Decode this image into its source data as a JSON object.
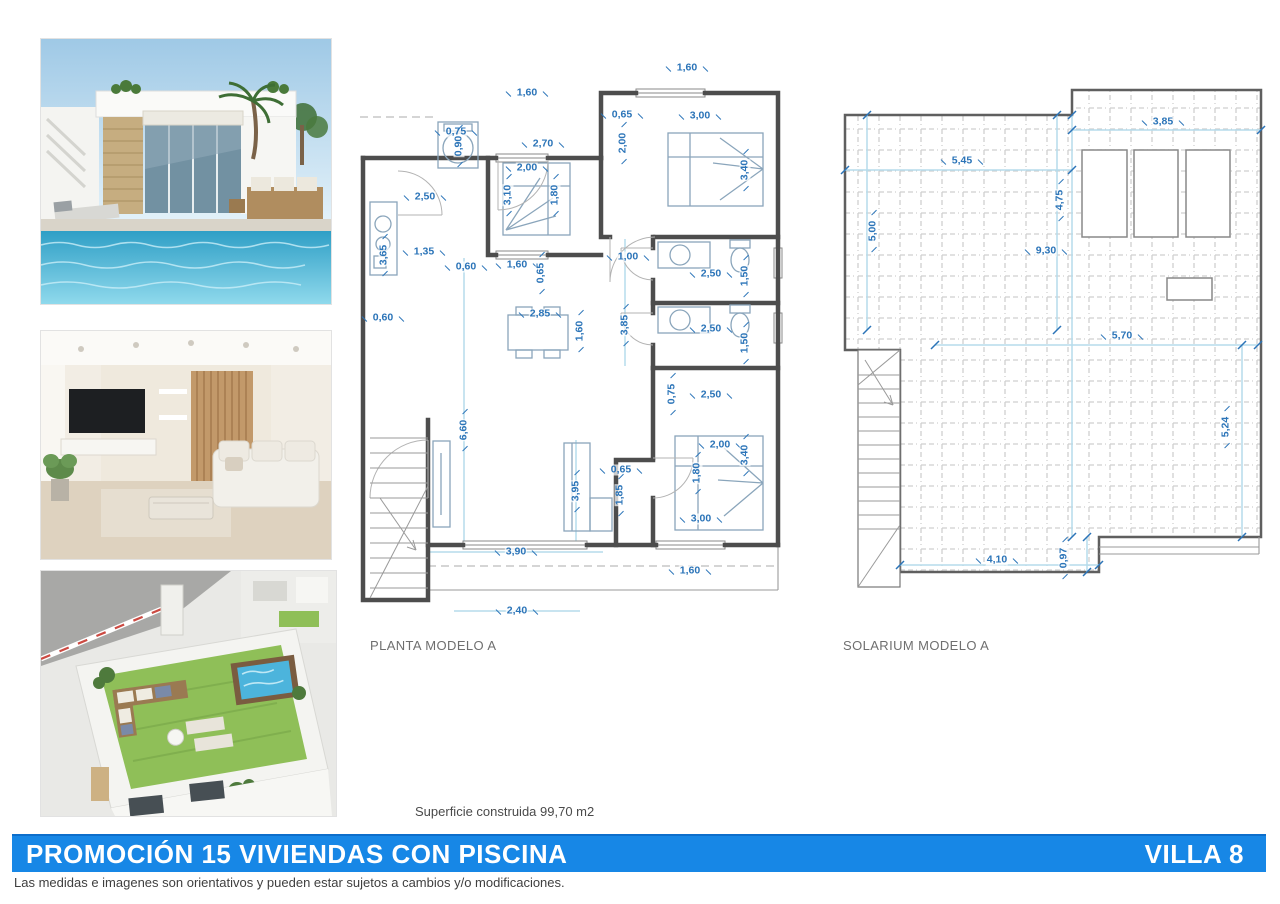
{
  "page": {
    "surface_note": "Superficie construida 99,70 m2",
    "banner": {
      "title": "PROMOCIÓN 15 VIVIENDAS CON PISCINA",
      "villa_label": "VILLA 8",
      "color": "#1787e6"
    },
    "disclaimer": "Las medidas e imagenes son orientativos y pueden estar sujetos a cambios y/o modificaciones."
  },
  "photos": [
    {
      "name": "villa-exterior-pool",
      "description": "Render of a white modern villa with stone pillar, covered terrace, rattan sofas, palm trees and private pool"
    },
    {
      "name": "living-room-interior",
      "description": "Render of a living room with TV wall, wood slat panel, white sofa and coffee table"
    },
    {
      "name": "rooftop-solarium-aerial",
      "description": "Aerial render of the rooftop solarium with artificial grass, lounge furniture and jacuzzi"
    }
  ],
  "colors": {
    "dimension_text": "#2b74b8",
    "walls": "#4d4d4d",
    "banner_blue": "#1787e6"
  },
  "plans": {
    "planta": {
      "label": "PLANTA MODELO A",
      "dimensions": [
        {
          "t": "1,60",
          "x": 169,
          "y": 35
        },
        {
          "t": "1,60",
          "x": 329,
          "y": 10
        },
        {
          "t": "0,75",
          "x": 98,
          "y": 74
        },
        {
          "t": "0,90",
          "x": 101,
          "y": 88,
          "r": true
        },
        {
          "t": "2,70",
          "x": 185,
          "y": 86
        },
        {
          "t": "2,00",
          "x": 169,
          "y": 110
        },
        {
          "t": "3,10",
          "x": 150,
          "y": 137,
          "r": true
        },
        {
          "t": "1,80",
          "x": 197,
          "y": 137,
          "r": true
        },
        {
          "t": "3,40",
          "x": 387,
          "y": 112,
          "r": true
        },
        {
          "t": "0,65",
          "x": 264,
          "y": 57
        },
        {
          "t": "3,00",
          "x": 342,
          "y": 58
        },
        {
          "t": "2,00",
          "x": 265,
          "y": 85,
          "r": true
        },
        {
          "t": "2,50",
          "x": 67,
          "y": 139
        },
        {
          "t": "1,35",
          "x": 66,
          "y": 194
        },
        {
          "t": "3,65",
          "x": 26,
          "y": 197,
          "r": true
        },
        {
          "t": "0,60",
          "x": 108,
          "y": 209
        },
        {
          "t": "1,60",
          "x": 159,
          "y": 207
        },
        {
          "t": "0,65",
          "x": 183,
          "y": 215,
          "r": true
        },
        {
          "t": "0,60",
          "x": 25,
          "y": 260
        },
        {
          "t": "1,00",
          "x": 270,
          "y": 199
        },
        {
          "t": "2,50",
          "x": 353,
          "y": 216
        },
        {
          "t": "1,50",
          "x": 387,
          "y": 218,
          "r": true
        },
        {
          "t": "2,85",
          "x": 182,
          "y": 256
        },
        {
          "t": "1,60",
          "x": 222,
          "y": 273,
          "r": true
        },
        {
          "t": "3,85",
          "x": 267,
          "y": 267,
          "r": true
        },
        {
          "t": "2,50",
          "x": 353,
          "y": 271
        },
        {
          "t": "1,50",
          "x": 387,
          "y": 285,
          "r": true
        },
        {
          "t": "0,75",
          "x": 314,
          "y": 336,
          "r": true
        },
        {
          "t": "2,50",
          "x": 353,
          "y": 337
        },
        {
          "t": "6,60",
          "x": 106,
          "y": 372,
          "r": true
        },
        {
          "t": "2,00",
          "x": 362,
          "y": 387
        },
        {
          "t": "1,80",
          "x": 339,
          "y": 415,
          "r": true
        },
        {
          "t": "3,40",
          "x": 387,
          "y": 397,
          "r": true
        },
        {
          "t": "0,65",
          "x": 263,
          "y": 412
        },
        {
          "t": "1,85",
          "x": 262,
          "y": 437,
          "r": true
        },
        {
          "t": "3,95",
          "x": 218,
          "y": 433,
          "r": true
        },
        {
          "t": "3,00",
          "x": 343,
          "y": 461
        },
        {
          "t": "3,90",
          "x": 158,
          "y": 494
        },
        {
          "t": "1,60",
          "x": 332,
          "y": 513
        },
        {
          "t": "2,40",
          "x": 159,
          "y": 553
        }
      ]
    },
    "solarium": {
      "label": "SOLARIUM MODELO A",
      "dimensions": [
        {
          "t": "3,85",
          "x": 328,
          "y": 37
        },
        {
          "t": "5,45",
          "x": 127,
          "y": 76
        },
        {
          "t": "5,00",
          "x": 38,
          "y": 146,
          "r": true
        },
        {
          "t": "4,75",
          "x": 225,
          "y": 115,
          "r": true
        },
        {
          "t": "9,30",
          "x": 211,
          "y": 166
        },
        {
          "t": "5,70",
          "x": 287,
          "y": 251
        },
        {
          "t": "5,24",
          "x": 391,
          "y": 342,
          "r": true
        },
        {
          "t": "4,10",
          "x": 162,
          "y": 475
        },
        {
          "t": "0,97",
          "x": 229,
          "y": 473,
          "r": true
        }
      ]
    }
  }
}
